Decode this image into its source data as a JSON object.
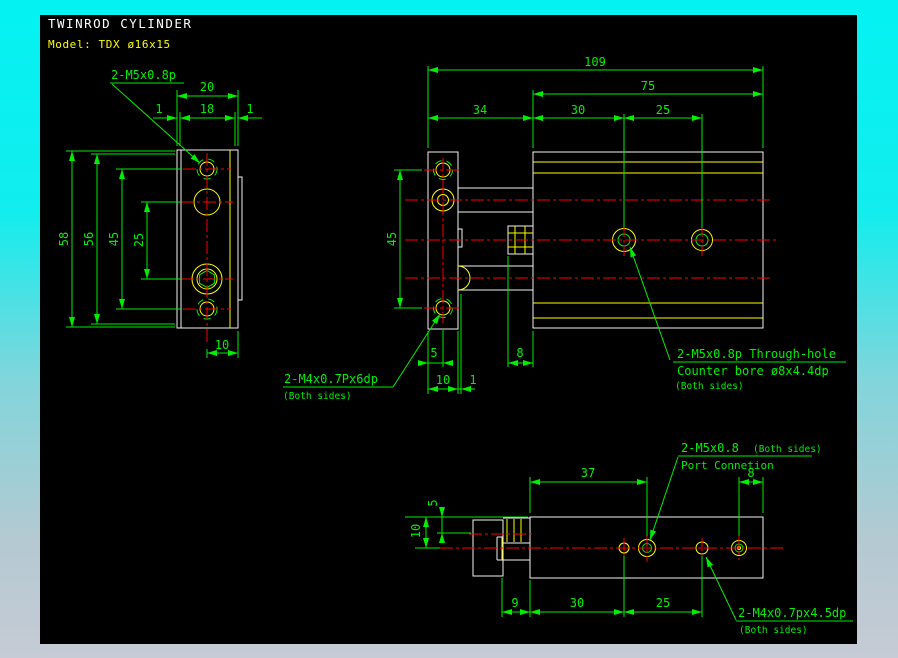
{
  "header": {
    "title": "TWINROD CYLINDER",
    "model": "Model: TDX ø16x15"
  },
  "colors": {
    "background": "#000000",
    "frame_top": "#04f2f2",
    "frame_bottom": "#c6cbd5",
    "geometry": "#f2f2f2",
    "detail": "#ffff00",
    "dimension": "#00ee00",
    "centerline": "#ff0000",
    "title_text": "#ffffff",
    "model_text": "#ffff00"
  },
  "front_view": {
    "callout": "2-M5x0.8p",
    "dims": {
      "d20": "20",
      "d18": "18",
      "d1a": "1",
      "d1b": "1",
      "d58": "58",
      "d56": "56",
      "d45": "45",
      "d25": "25",
      "d10": "10"
    }
  },
  "top_view": {
    "dims": {
      "d109": "109",
      "d75": "75",
      "d34": "34",
      "d30": "30",
      "d25": "25",
      "d45": "45",
      "d5": "5",
      "d10": "10",
      "d1": "1",
      "d8": "8"
    },
    "callout_tap": {
      "line1": "2-M4x0.7Px6dp",
      "line2": "(Both sides)"
    },
    "callout_through": {
      "line1": "2-M5x0.8p Through-hole",
      "line2": "Counter bore ø8x4.4dp",
      "line3": "(Both sides)"
    }
  },
  "bottom_view": {
    "dims": {
      "d37": "37",
      "d8": "8",
      "d5": "5",
      "d10": "10",
      "d9": "9",
      "d30": "30",
      "d25": "25"
    },
    "callout_port": {
      "label": "2-M5x0.8",
      "sides": "(Both sides)",
      "line2": "Port Connetion"
    },
    "callout_tap": {
      "line1": "2-M4x0.7px4.5dp",
      "line2": "(Both sides)"
    }
  }
}
